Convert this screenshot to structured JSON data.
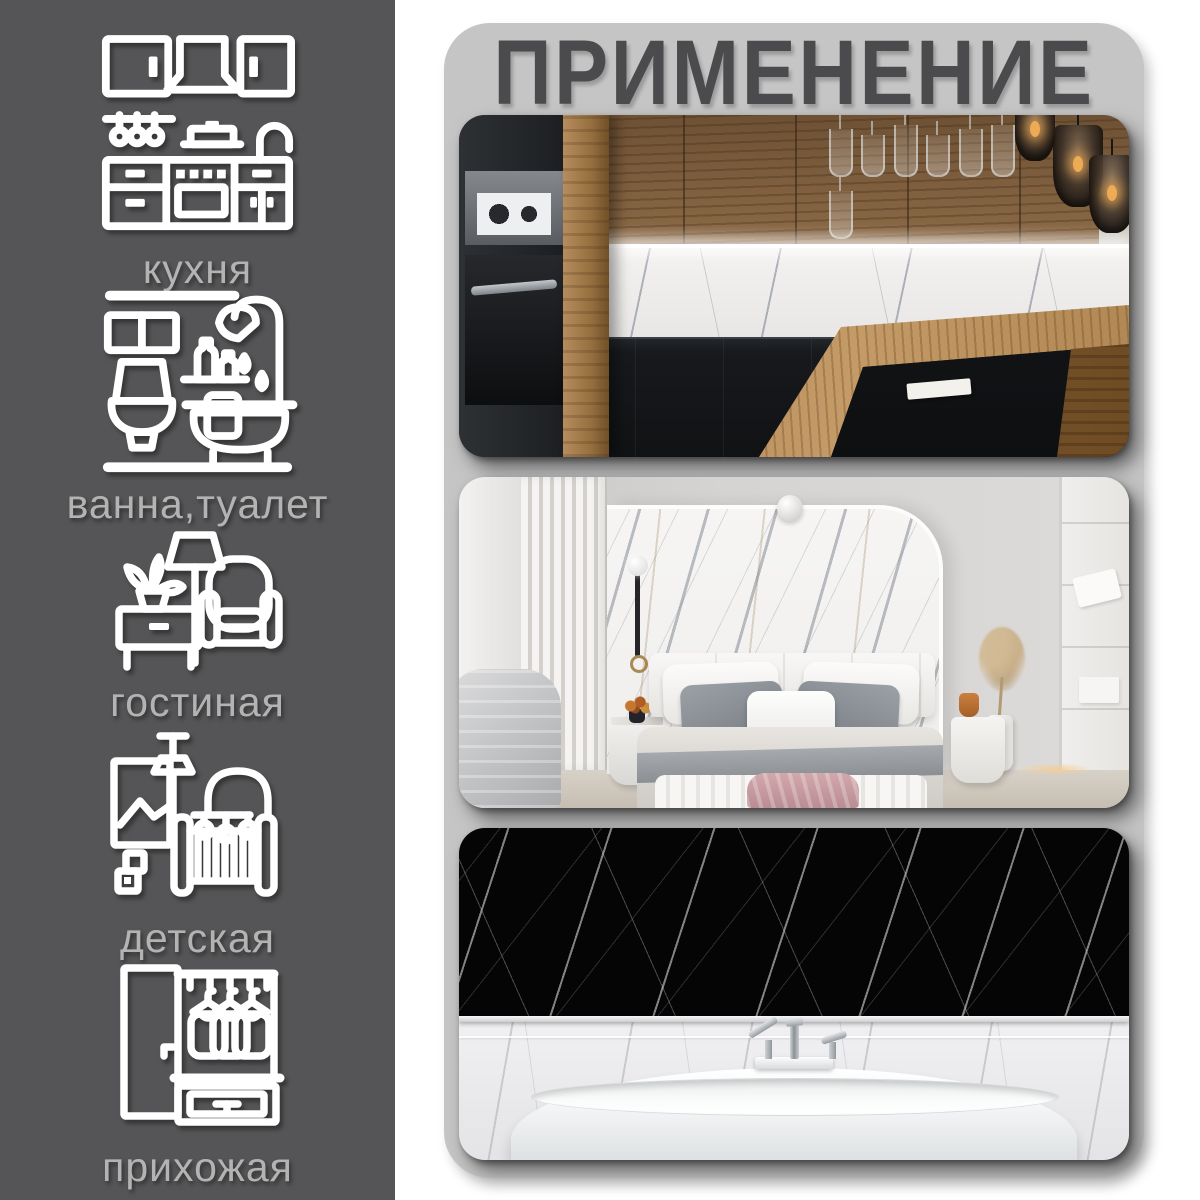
{
  "header": {
    "title": "ПРИМЕНЕНИЕ"
  },
  "sidebar": {
    "items": [
      {
        "id": "kitchen",
        "label": "кухня",
        "icon": "kitchen-set-icon"
      },
      {
        "id": "bathroom",
        "label": "ванна,туалет",
        "icon": "bath-toilet-icon"
      },
      {
        "id": "living-room",
        "label": "гостиная",
        "icon": "armchair-floor-lamp-icon"
      },
      {
        "id": "nursery",
        "label": "детская",
        "icon": "baby-crib-icon"
      },
      {
        "id": "hallway",
        "label": "прихожая",
        "icon": "hallway-wardrobe-icon"
      }
    ]
  },
  "gallery": {
    "photos": [
      {
        "name": "kitchen-interior-photo",
        "subject": "kitchen with wood cabinets, white marble backsplash, black counters and wood island"
      },
      {
        "name": "bedroom-interior-photo",
        "subject": "bedroom with white marble accent wall behind bed"
      },
      {
        "name": "bathroom-interior-photo",
        "subject": "black marble wall above a white freestanding bathtub"
      }
    ]
  },
  "colors": {
    "sidebar_bg": "#555557",
    "panel_bg": "#c5c5c5",
    "title_text": "#4b4b4d",
    "label_text": "#b3b3b3",
    "icon_stroke": "#ffffff",
    "wood": "#8c6a46",
    "marble_white": "#f2f1ef",
    "marble_black": "#050506"
  }
}
